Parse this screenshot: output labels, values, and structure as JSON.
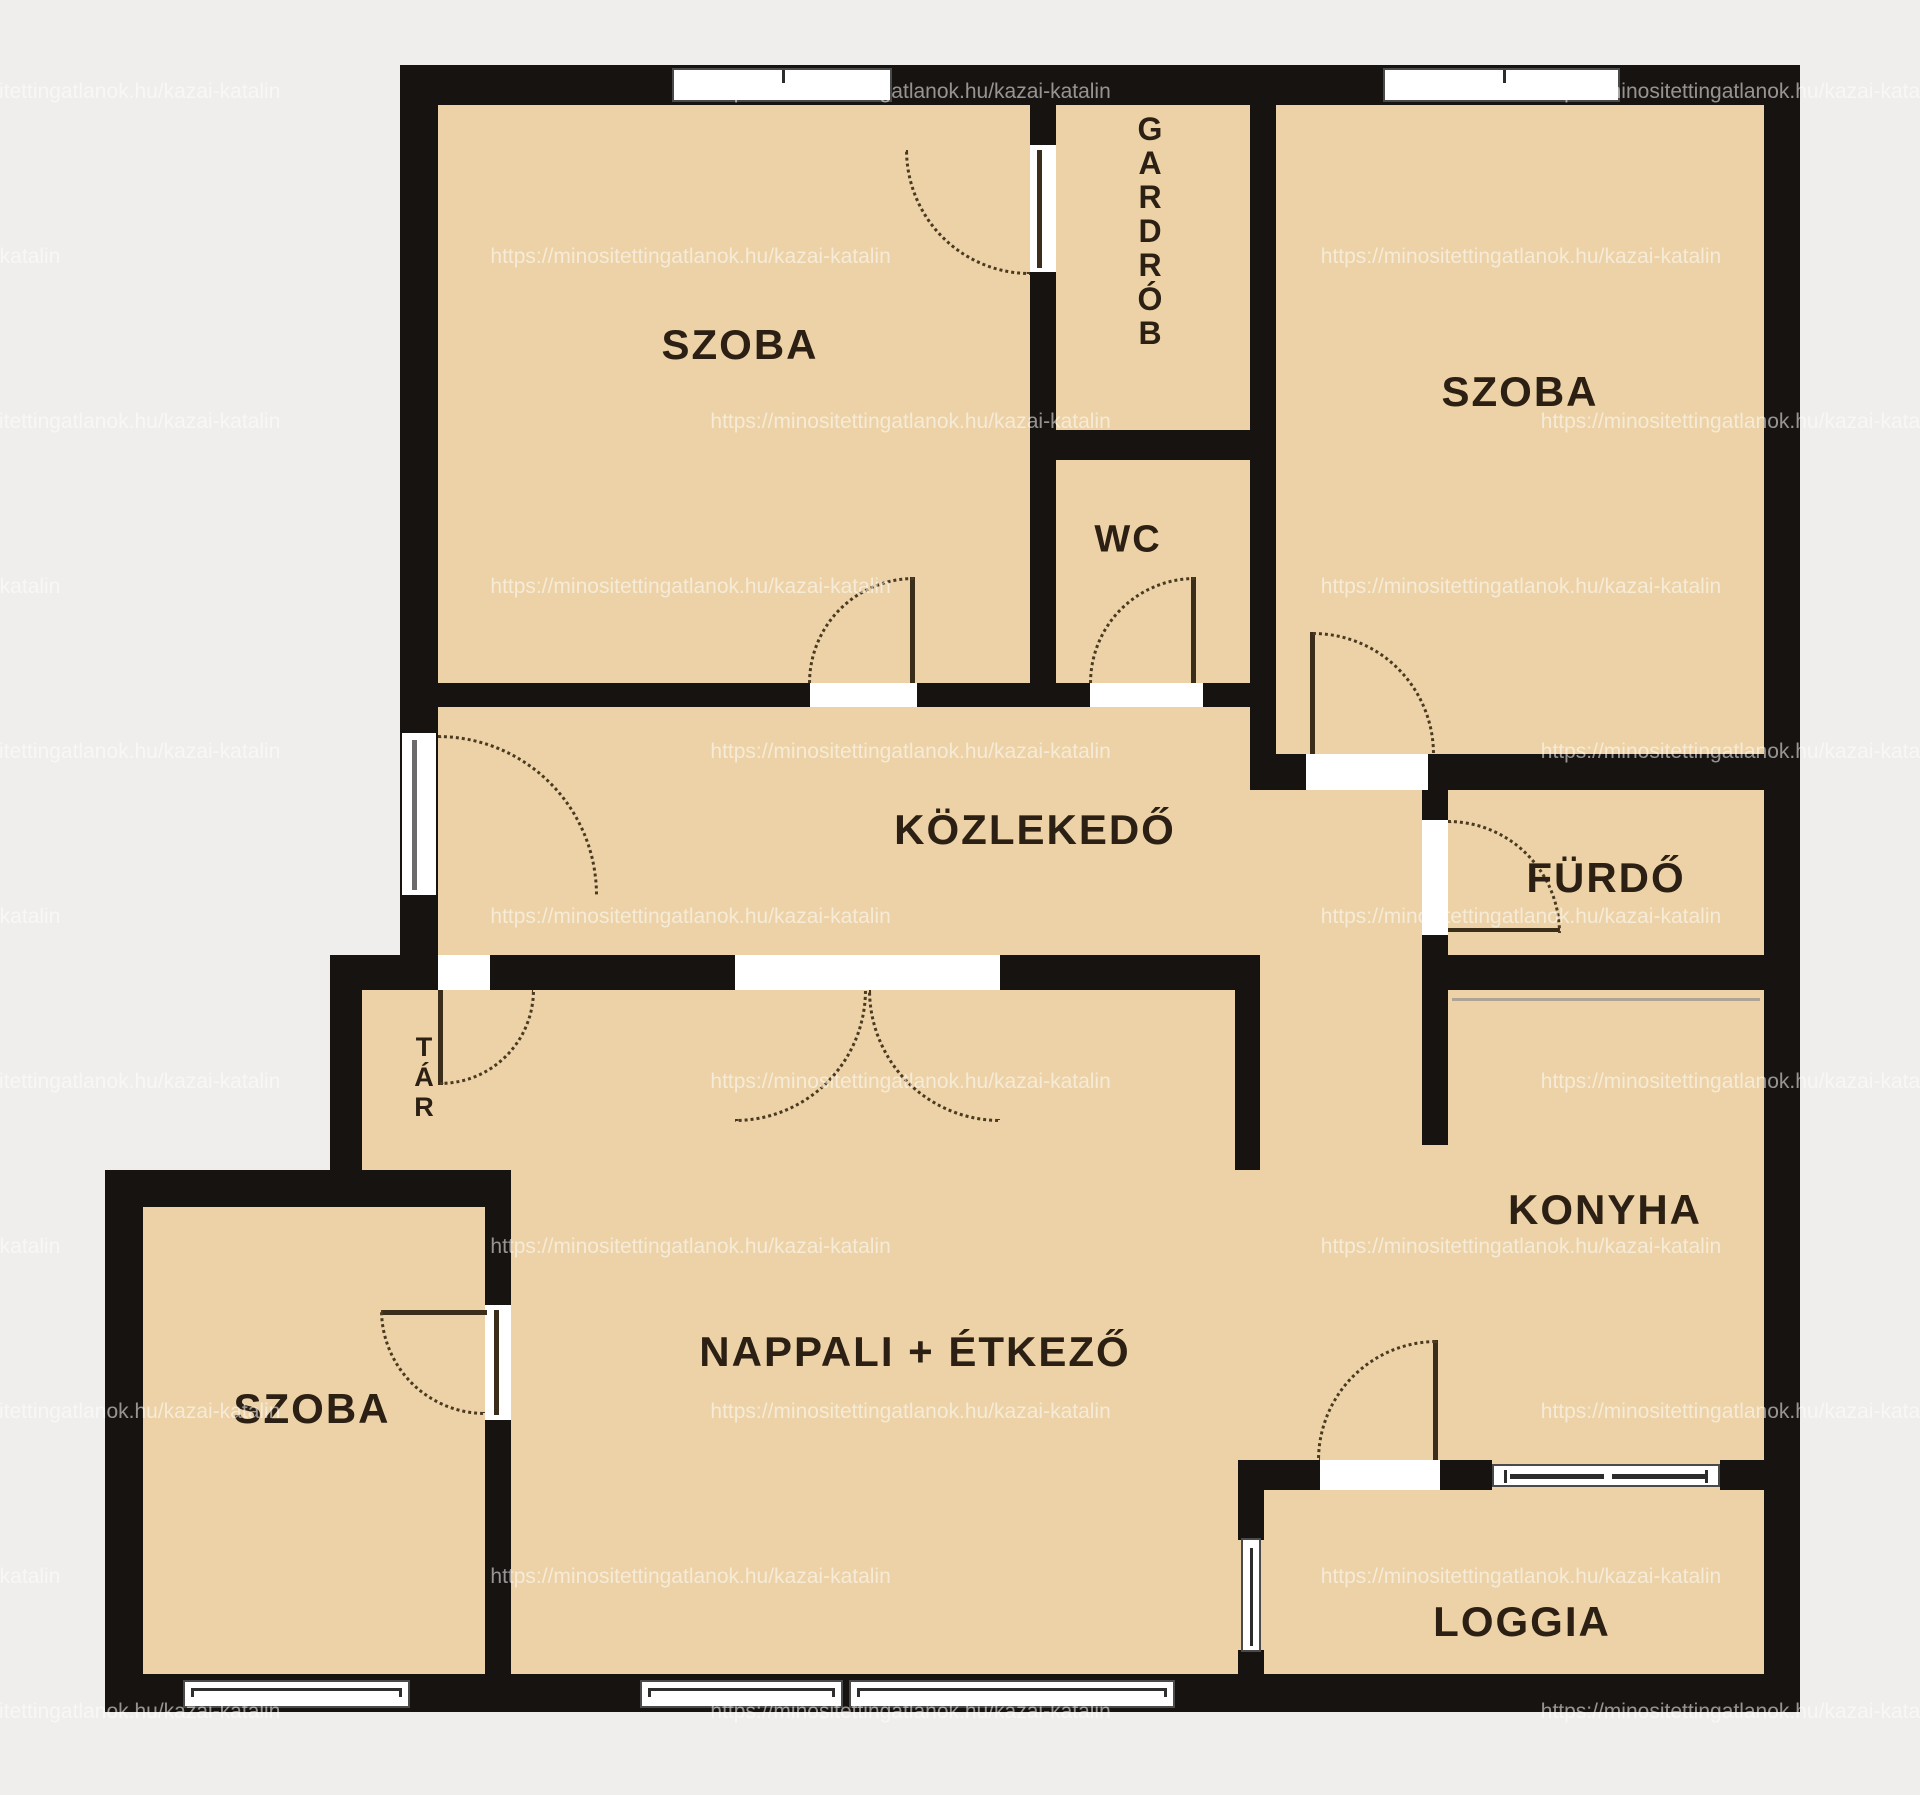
{
  "watermark": {
    "url": "https://minositettingatlanok.hu/kazai-katalin"
  },
  "colors": {
    "background": "#efeeec",
    "floor": "#ecd2a6",
    "wall": "#171310",
    "label_text": "#2b2013",
    "door_arc": "#4a3a22",
    "window_fill": "#ffffff"
  },
  "rooms": {
    "szoba_top_left": {
      "label": "SZOBA"
    },
    "gardrob": {
      "label": "GARDRÓB",
      "letters": [
        "G",
        "A",
        "R",
        "D",
        "R",
        "Ó",
        "B"
      ]
    },
    "szoba_top_right": {
      "label": "SZOBA"
    },
    "wc": {
      "label": "WC"
    },
    "kozlekedo": {
      "label": "KÖZLEKEDŐ"
    },
    "furdo": {
      "label": "FÜRDŐ"
    },
    "tar": {
      "label": "TÁR",
      "letters": [
        "T",
        "Á",
        "R"
      ]
    },
    "konyha": {
      "label": "KONYHA"
    },
    "nappali": {
      "label": "NAPPALI + ÉTKEZŐ"
    },
    "szoba_bottom_left": {
      "label": "SZOBA"
    },
    "loggia": {
      "label": "LOGGIA"
    }
  }
}
